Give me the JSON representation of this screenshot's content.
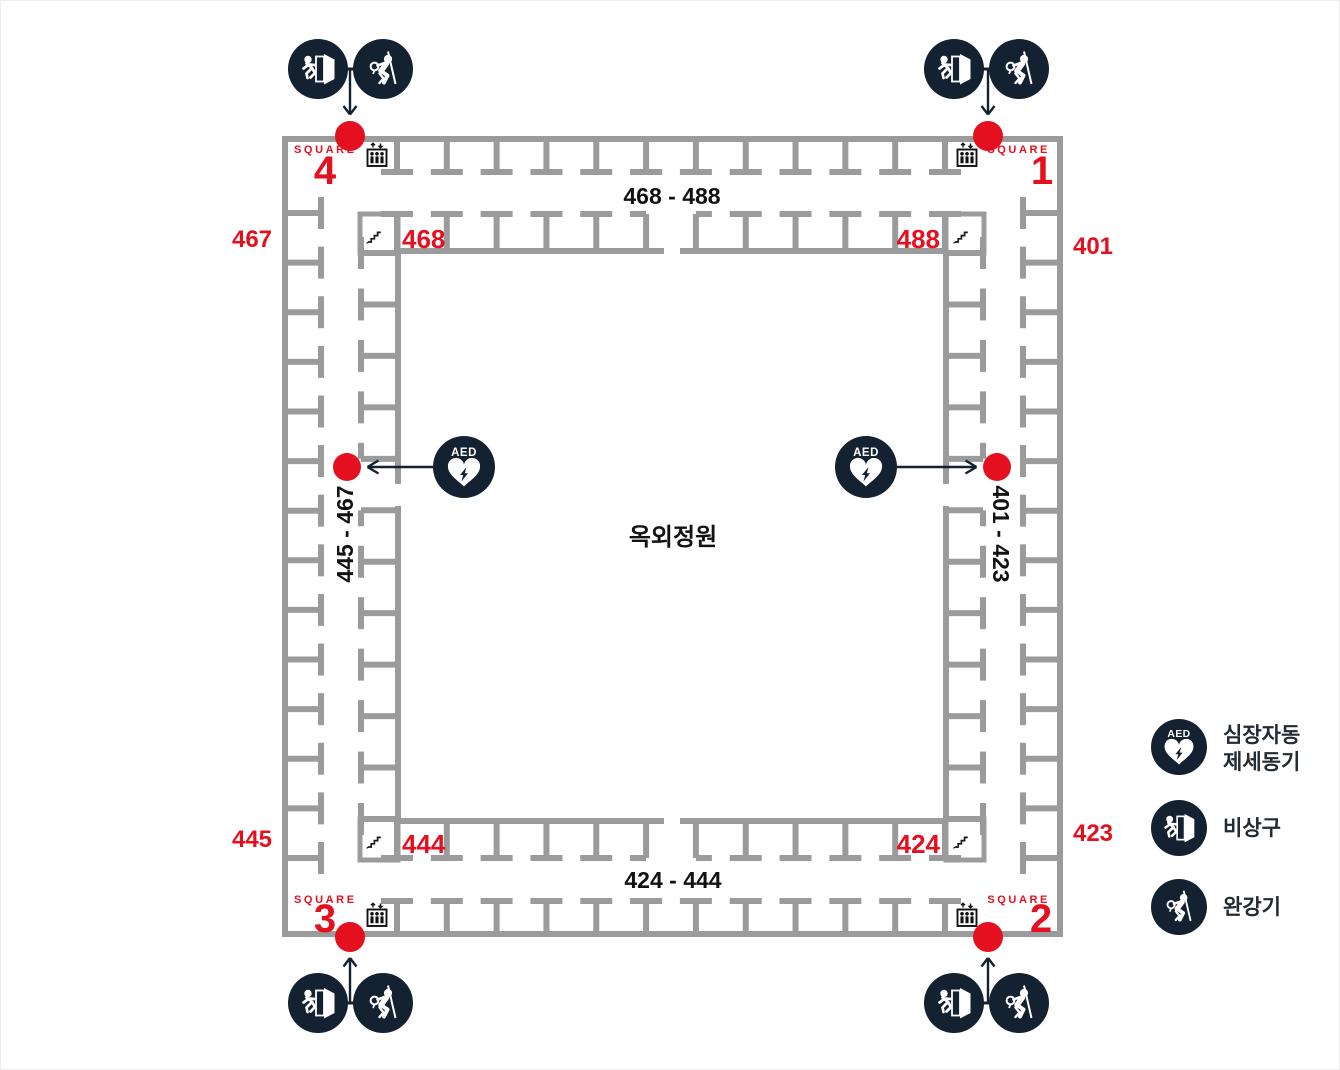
{
  "map": {
    "center_label": "옥외정원",
    "aed_badge": "AED",
    "corridor_ranges": {
      "top": "468 - 488",
      "bottom": "424 - 444",
      "left": "445 - 467",
      "right": "401 - 423"
    },
    "corners": {
      "top_left": {
        "word": "SQUARE",
        "number": "4",
        "inner_room": "468",
        "outer_room": "467"
      },
      "top_right": {
        "word": "SQUARE",
        "number": "1",
        "inner_room": "488",
        "outer_room": "401"
      },
      "bottom_left": {
        "word": "SQUARE",
        "number": "3",
        "inner_room": "444",
        "outer_room": "445"
      },
      "bottom_right": {
        "word": "SQUARE",
        "number": "2",
        "inner_room": "424",
        "outer_room": "423"
      }
    }
  },
  "legend": {
    "aed": {
      "icon": "aed-icon",
      "lines": [
        "심장자동",
        "제세동기"
      ]
    },
    "exit": {
      "icon": "exit-icon",
      "label": "비상구"
    },
    "descender": {
      "icon": "descender-icon",
      "label": "완강기"
    }
  },
  "colors": {
    "wall": "#9b9b9b",
    "red": "#e5101f",
    "navy": "#142130",
    "text": "#121212"
  }
}
